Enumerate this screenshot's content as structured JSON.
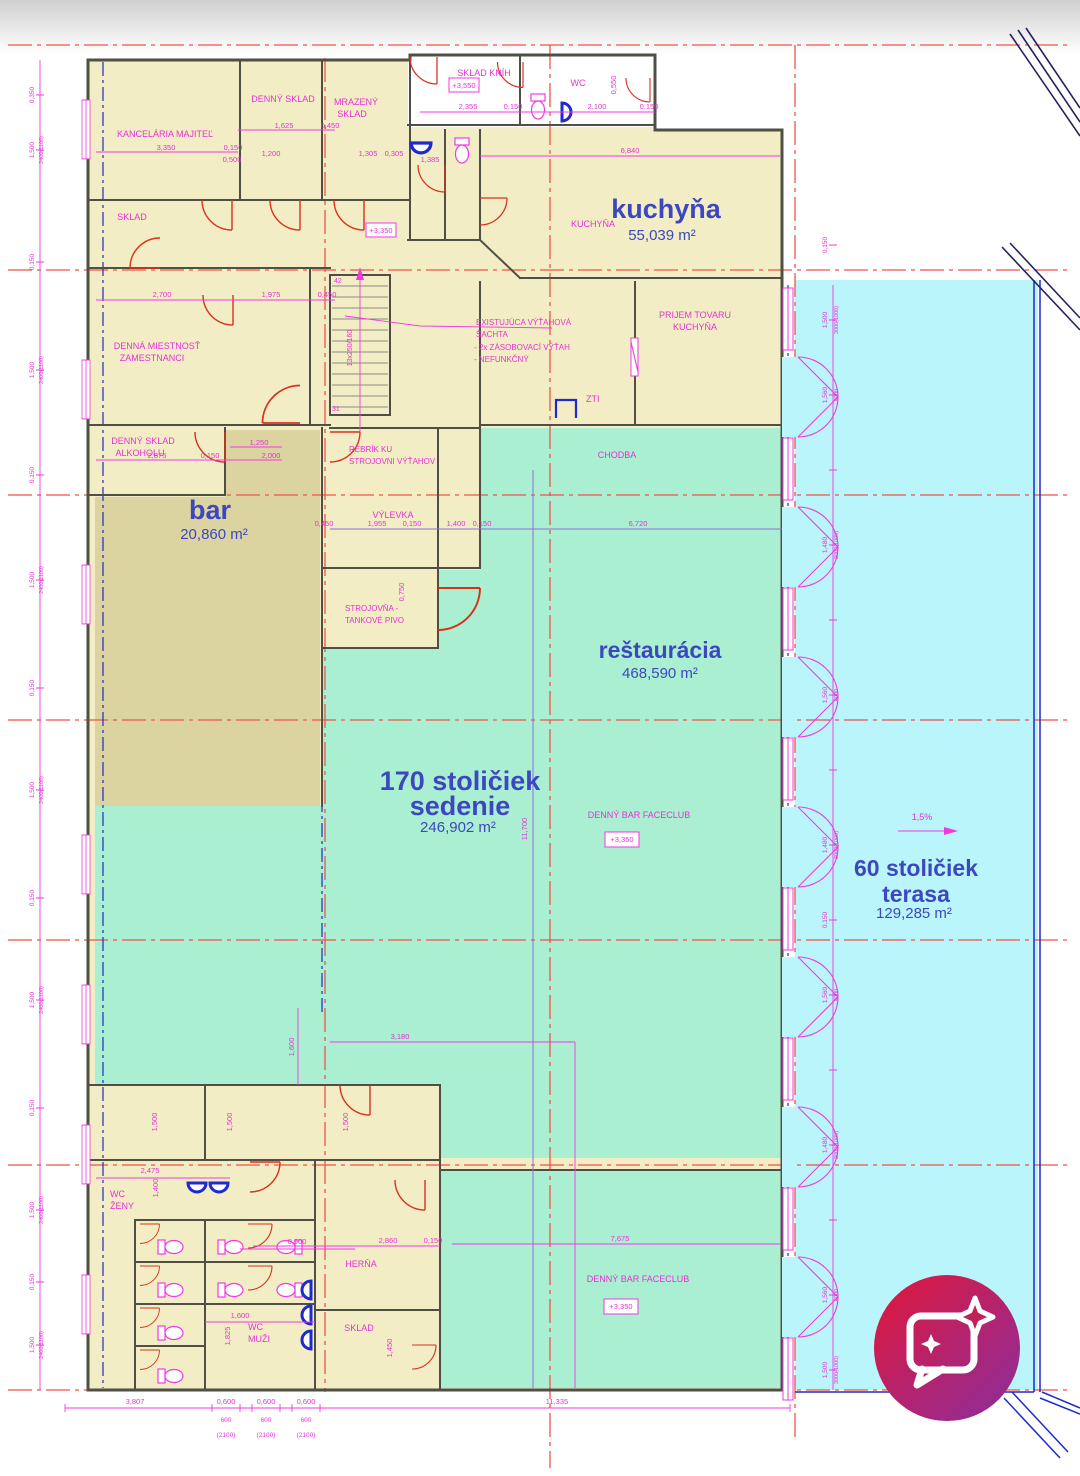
{
  "areas": {
    "kuchyna_name": "kuchyňa",
    "kuchyna_area": "55,039 m²",
    "bar_name": "bar",
    "bar_area": "20,860 m²",
    "rest_name": "reštaurácia",
    "rest_area": "468,590 m²",
    "sedenie_l1": "170 stoličiek",
    "sedenie_l2": "sedenie",
    "sedenie_area": "246,902 m²",
    "terasa_l1": "60 stoličiek",
    "terasa_l2": "terasa",
    "terasa_area": "129,285 m²"
  },
  "rooms": {
    "kancelaria": "KANCELÁRIA MAJITEĽ",
    "sklad": "SKLAD",
    "denny_sklad": "DENNÝ SKLAD",
    "mrazeny_l1": "MRAZENÝ",
    "mrazeny_l2": "SKLAD",
    "sklad_knih": "SKLAD KNÍH",
    "wc": "WC",
    "kuchyna_small": "KUCHYŇA",
    "prijem_l1": "PRIJEM TOVARU",
    "prijem_l2": "KUCHYŇA",
    "denna_l1": "DENNÁ MIESTNOSŤ",
    "denna_l2": "ZAMESTNANCI",
    "alkohol_l1": "DENNÝ SKLAD",
    "alkohol_l2": "ALKOHOLU",
    "sachta_l1": "EXISTUJÚCA VÝŤAHOVÁ",
    "sachta_l2": "ŠACHTA",
    "sachta_l3": "- 2x ZÁSOBOVACÍ VÝŤAH",
    "sachta_l4": "- NEFUNKČNÝ",
    "zti": "ZTI",
    "chodba": "CHODBA",
    "rebrik_l1": "REBRÍK KU",
    "rebrik_l2": "STROJOVNI VÝŤAHOV",
    "vylevka": "VÝLEVKA",
    "stroj_l1": "STROJOVŇA -",
    "stroj_l2": "TANKOVÉ PIVO",
    "faceclub": "DENNÝ BAR FACECLUB",
    "wc_zeny_l1": "WC",
    "wc_zeny_l2": "ŽENY",
    "wc_muzi_l1": "WC",
    "wc_muzi_l2": "MUŽI",
    "herna": "HERŇA",
    "sklad_dole": "SKLAD"
  },
  "levels": {
    "p3550": "+3,550",
    "p3350": "+3,350"
  },
  "stairs": {
    "top": "42",
    "bottom": "31",
    "spec": "13x250/160"
  },
  "slope": {
    "label": "1,5%"
  },
  "dims": {
    "v3350": "3,350",
    "v0150": "0,150",
    "v1625": "1,625",
    "v0450": "0,450",
    "v1200": "1,200",
    "v0500": "0,500",
    "v1305": "1,305",
    "v0305": "0,305",
    "v1385": "1,385",
    "v2355": "2,355",
    "v2100": "2,100",
    "v6840": "6,840",
    "v0550": "0,550",
    "v2700": "2,700",
    "v1975": "1,975",
    "v2875": "2,875",
    "v1250": "1,250",
    "v2000": "2,000",
    "v1955": "1,955",
    "v1400": "1,400",
    "v6720": "6,720",
    "v0750": "0,750",
    "v3180": "3,180",
    "v1600": "1,600",
    "v11700": "11,700",
    "v7675": "7,675",
    "v2860": "2,860",
    "v2475": "2,475",
    "v0900": "0,900",
    "v1825": "1,825",
    "v1500": "1,500",
    "v1450": "1,450"
  },
  "chain": {
    "win": "1,500",
    "gap": "0,150",
    "gap2": "0,350",
    "specL": "2400(1100)",
    "specR": "3000(1000)",
    "door": "1,560",
    "doorSpec": "4000",
    "win2": "1,480"
  },
  "bottom": {
    "v3807": "3,807",
    "v0600": "0,600",
    "v600": "600",
    "v2100p": "(2100)",
    "v11335": "11,335"
  }
}
